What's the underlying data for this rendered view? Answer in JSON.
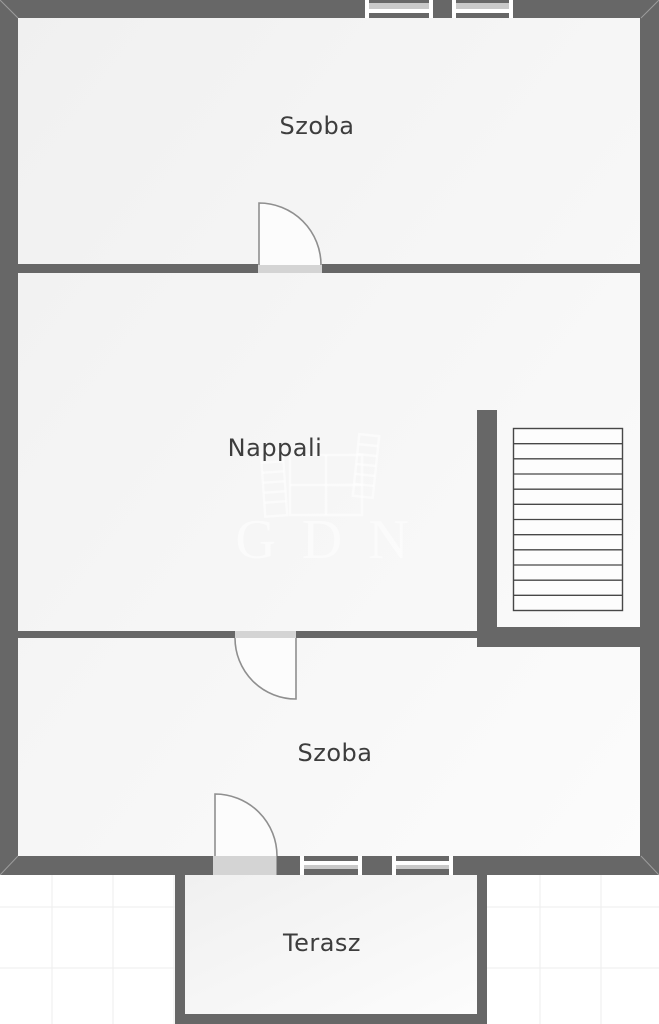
{
  "rooms": [
    {
      "id": "szoba-1",
      "label": "Szoba"
    },
    {
      "id": "nappali",
      "label": "Nappali"
    },
    {
      "id": "szoba-2",
      "label": "Szoba"
    },
    {
      "id": "terasz",
      "label": "Terasz"
    }
  ],
  "watermark": {
    "text": "GDN"
  },
  "stairs": {
    "treads": 12
  },
  "features": {
    "doors": 3,
    "windows_top_wall": 2,
    "windows_bottom_wall": 2
  },
  "colors": {
    "wall": "#676767",
    "room_fill_dark": "#f0f0f0",
    "room_fill_light": "#fcfcfc",
    "door_opening": "#d4d4d4",
    "window_glass": "#c9c9c9",
    "label_text": "#3d3d3d",
    "background": "#ffffff",
    "grid_line": "#ededed",
    "watermark": "rgba(255,255,255,0.55)"
  }
}
